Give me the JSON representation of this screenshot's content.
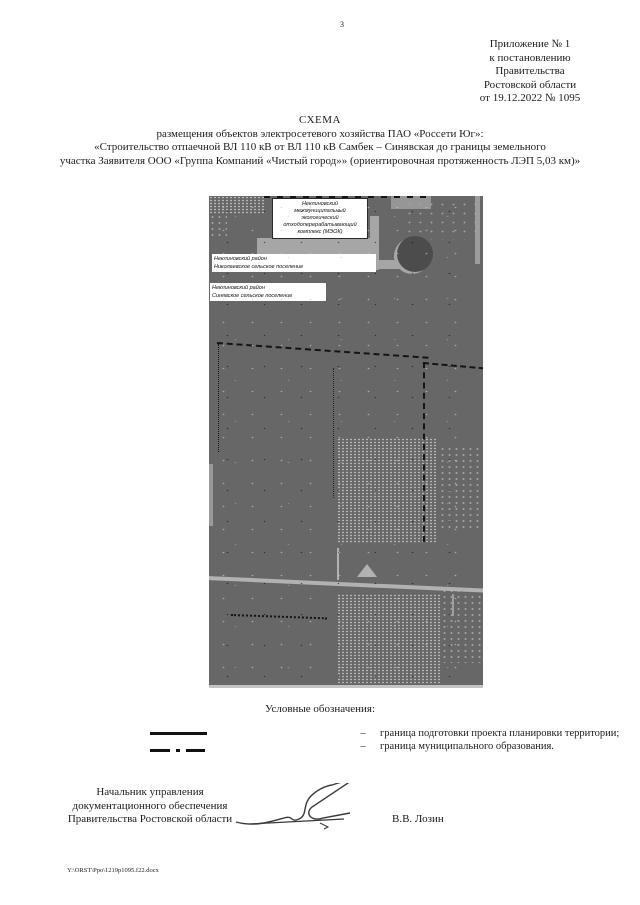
{
  "page": {
    "number": "3",
    "footer_path": "Y:\\ORST\\Ppo\\1219p1095.f22.docx"
  },
  "appendix": {
    "lines": [
      "Приложение № 1",
      "к постановлению",
      "Правительства",
      "Ростовской области",
      "от 19.12.2022 № 1095"
    ]
  },
  "title": {
    "heading": "СХЕМА",
    "lines": [
      "размещения объектов электросетевого хозяйства ПАО «Россети Юг»:",
      "«Строительство отпаечной ВЛ 110 кВ от ВЛ 110 кВ Самбек – Синявская до границы земельного",
      "участка Заявителя ООО «Группа Компаний «Чистый город»» (ориентировочная протяженность ЛЭП 5,03 км)»"
    ]
  },
  "map": {
    "meok_label": {
      "line1": "Неклиновский",
      "line2": "межмуниципальный",
      "line3": "экологический",
      "line4": "отходоперерабатывающий",
      "line5": "комплекс (МЭОК)"
    },
    "district_label_1": {
      "line1": "Неклиновский район",
      "line2": "Николаевское сельское поселение"
    },
    "district_label_2": {
      "line1": "Неклиновский район",
      "line2": "Синявское сельское поселение"
    },
    "colors": {
      "base": "#676767",
      "patch": "#a6a6a6",
      "road": "#b2b2b2",
      "boundary": "#141414"
    }
  },
  "legend": {
    "title": "Условные обозначения:",
    "items": [
      {
        "symbol": "solid-line",
        "separator": "–",
        "label": "граница подготовки проекта планировки территории;"
      },
      {
        "symbol": "dash-dot-line",
        "separator": "–",
        "label": "граница муниципального образования."
      }
    ]
  },
  "signature": {
    "position_line1": "Начальник управления",
    "position_line2": "документационного обеспечения",
    "position_line3": "Правительства Ростовской области",
    "name": "В.В. Лозин"
  }
}
